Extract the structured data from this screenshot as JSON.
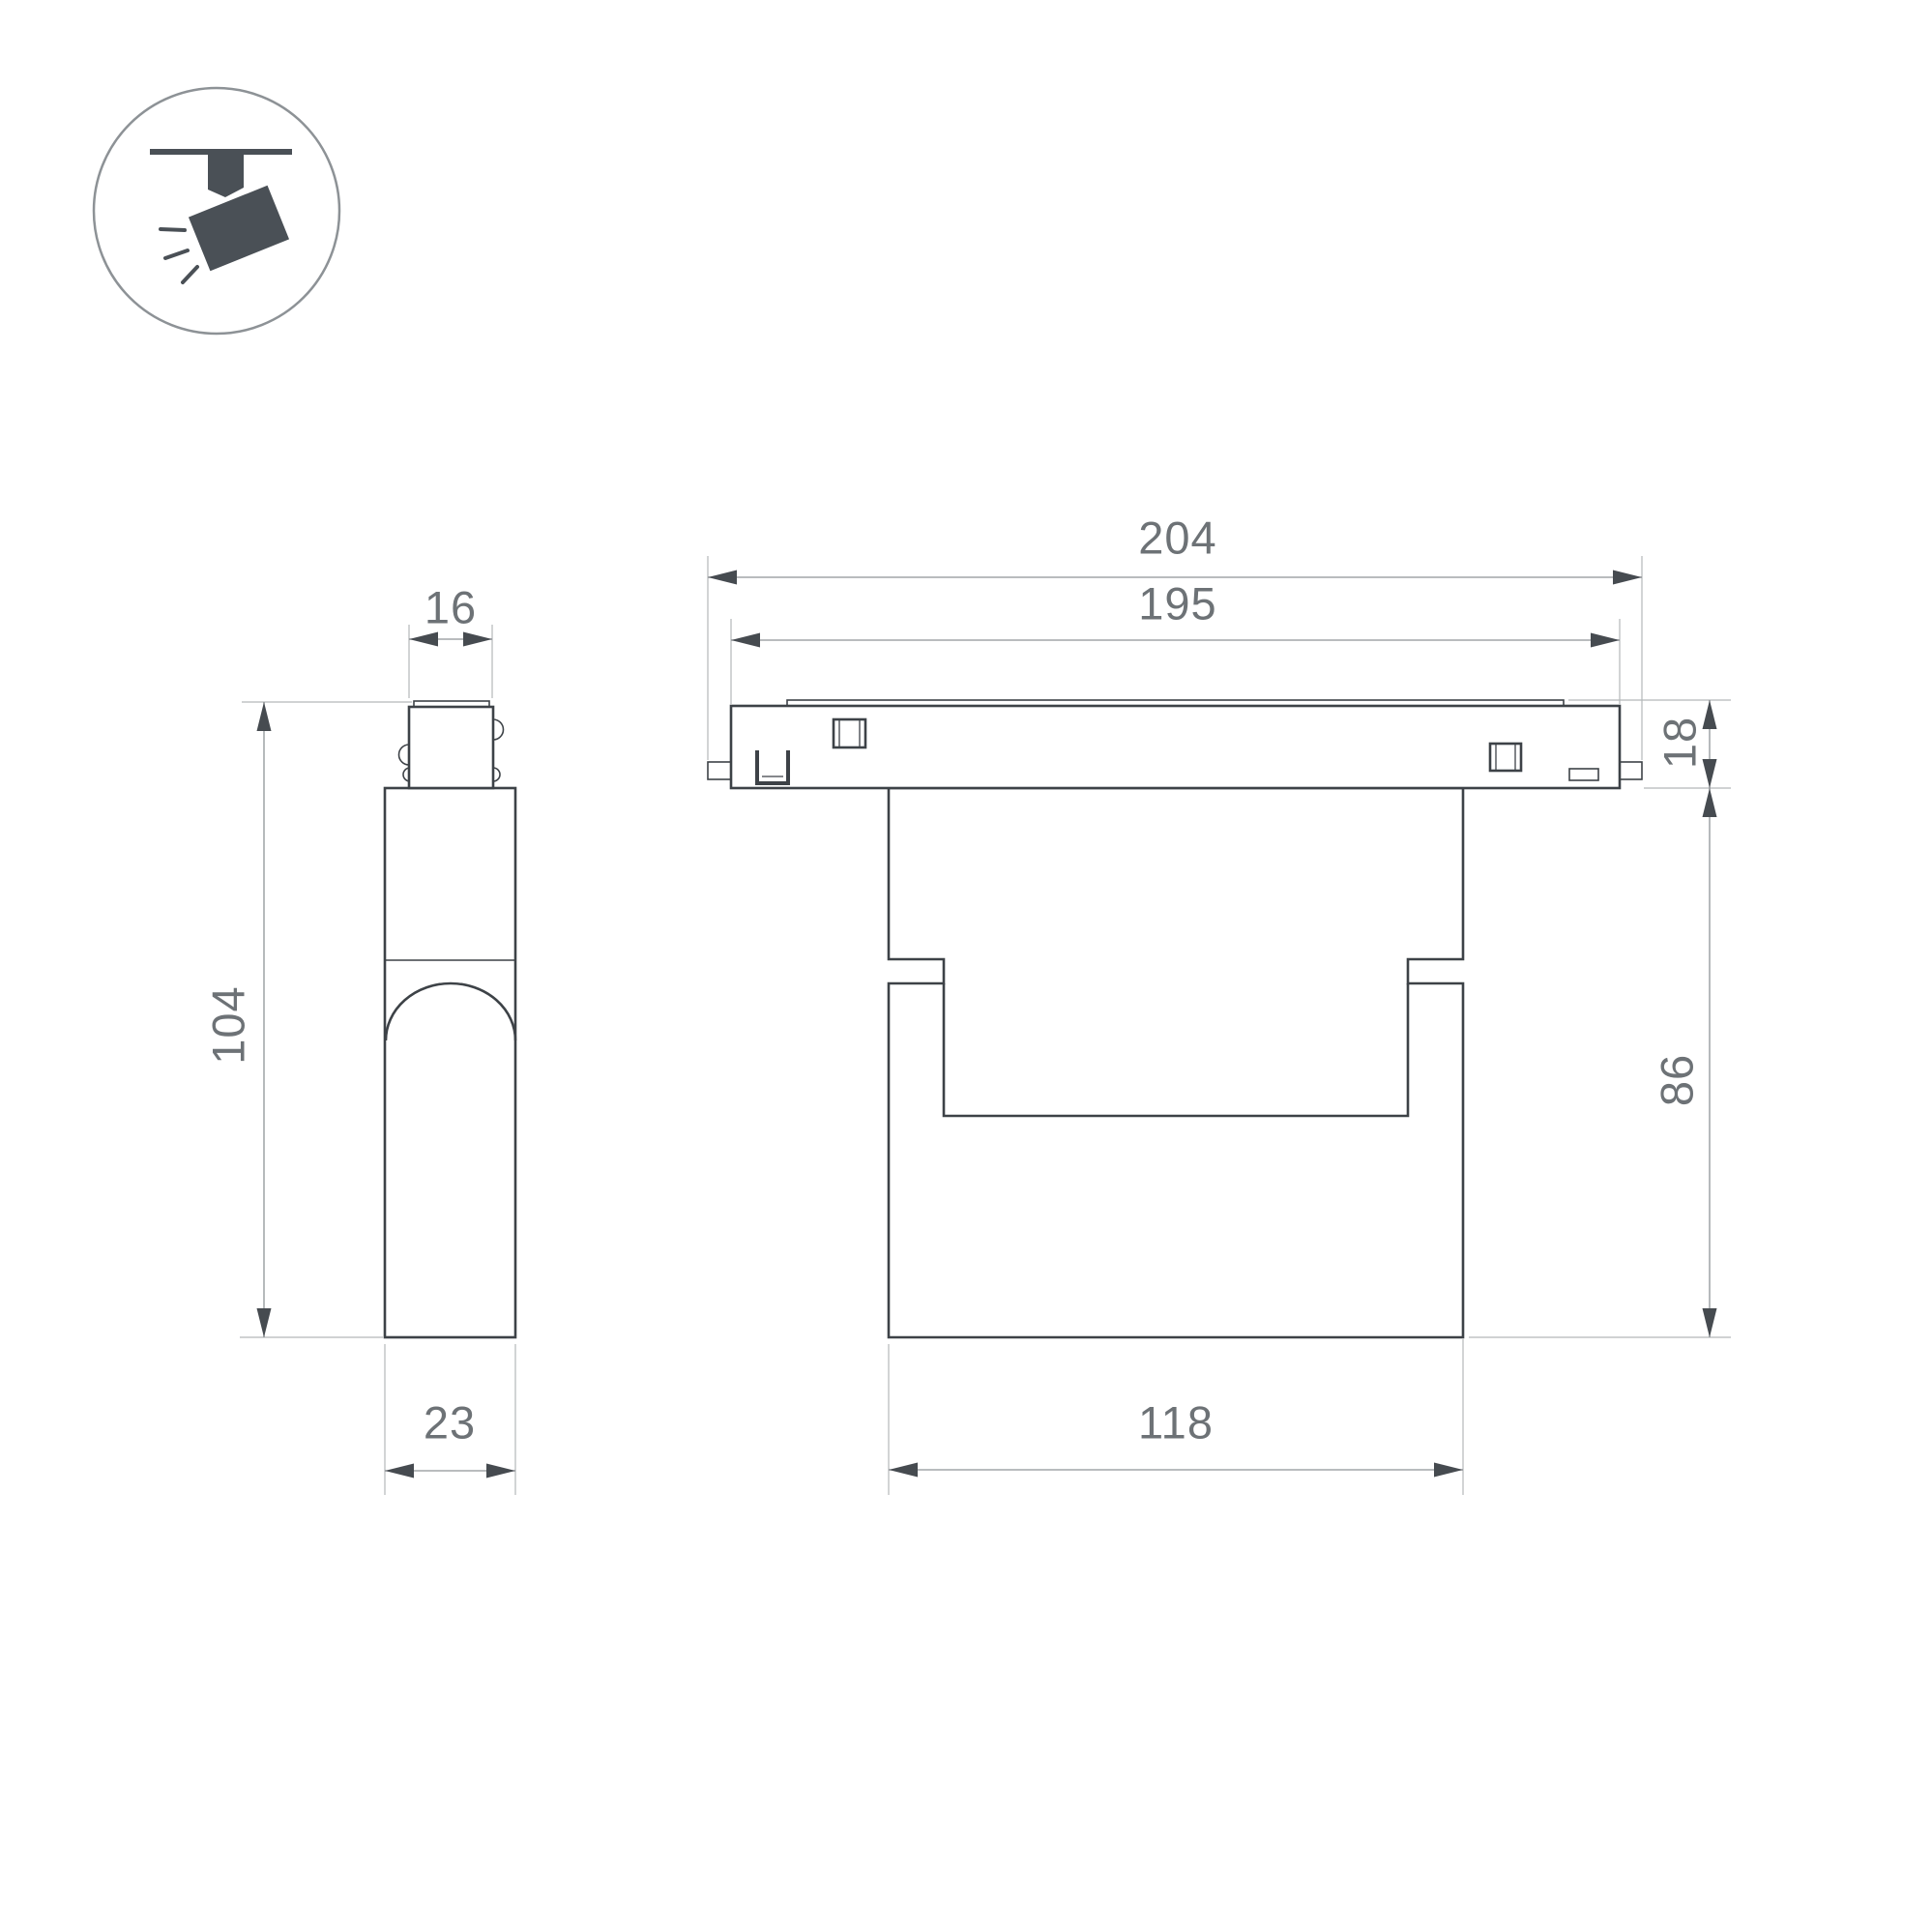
{
  "colors": {
    "bg": "#ffffff",
    "outline": "#3d4247",
    "dim_line": "#8f9497",
    "ext_line": "#b3b7b9",
    "arrow": "#464b50",
    "dim_text": "#6d7276",
    "icon_fill": "#4a5056",
    "icon_circle": "#8d9296"
  },
  "icon": {
    "name": "ceiling-track-spotlight",
    "parts": [
      "track-bar",
      "mount-stem",
      "lamp-head",
      "light-rays"
    ]
  },
  "views": {
    "side": {
      "name": "side-view"
    },
    "front": {
      "name": "front-view"
    }
  },
  "dimensions": {
    "overall_length": "204",
    "body_length": "195",
    "adapter_width": "16",
    "track_height": "18",
    "overall_height": "104",
    "body_height": "86",
    "body_depth": "23",
    "head_length": "118"
  }
}
